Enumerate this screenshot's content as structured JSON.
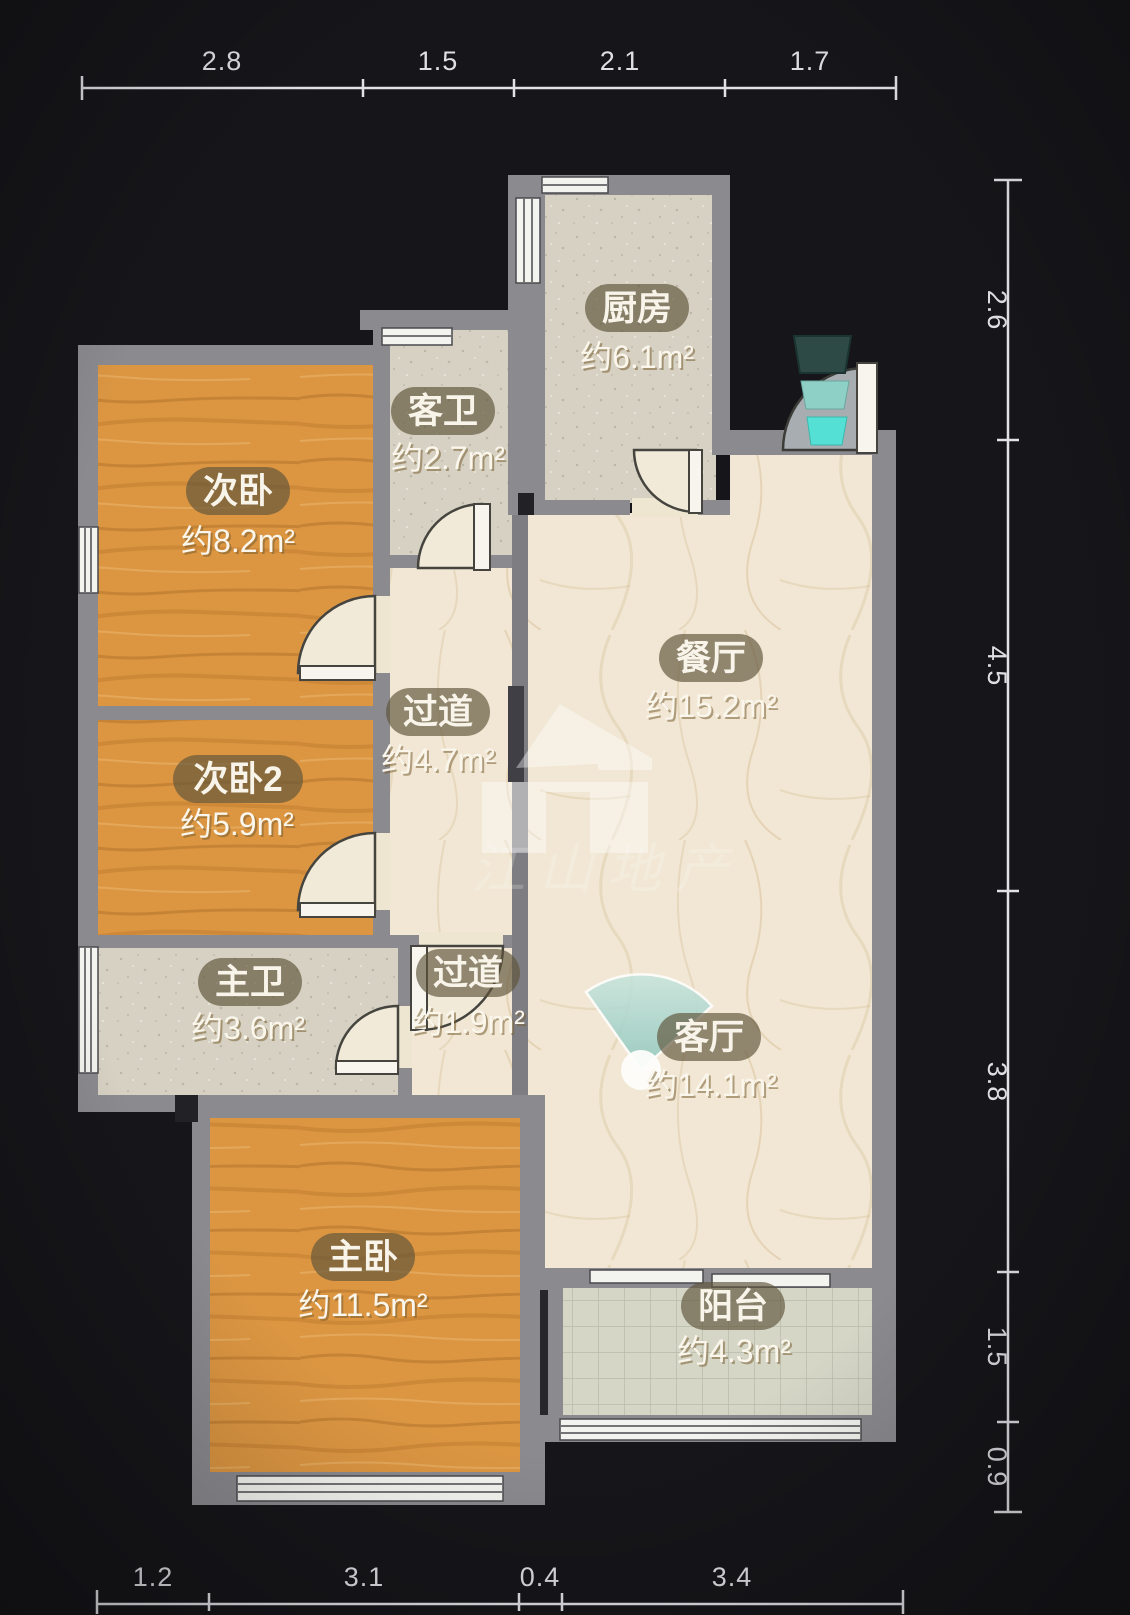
{
  "plan": {
    "type": "floorplan",
    "watermark": {
      "text": "江山地产"
    },
    "dimensions_m": {
      "top": [
        "2.8",
        "1.5",
        "2.1",
        "1.7"
      ],
      "right": [
        "2.6",
        "4.5",
        "3.8",
        "1.5",
        "0.9"
      ],
      "bottom": [
        "1.2",
        "3.1",
        "0.4",
        "3.4"
      ]
    },
    "rooms": {
      "ciwo": {
        "name": "次卧",
        "area": "约8.2m²"
      },
      "kewei": {
        "name": "客卫",
        "area": "约2.7m²"
      },
      "chufang": {
        "name": "厨房",
        "area": "约6.1m²"
      },
      "canting": {
        "name": "餐厅",
        "area": "约15.2m²"
      },
      "guodao1": {
        "name": "过道",
        "area": "约4.7m²"
      },
      "ciwo2": {
        "name": "次卧2",
        "area": "约5.9m²"
      },
      "zhuwei": {
        "name": "主卫",
        "area": "约3.6m²"
      },
      "guodao2": {
        "name": "过道",
        "area": "约1.9m²"
      },
      "keting": {
        "name": "客厅",
        "area": "约14.1m²"
      },
      "zhuwo": {
        "name": "主卧",
        "area": "约11.5m²"
      },
      "yangtai": {
        "name": "阳台",
        "area": "约4.3m²"
      }
    },
    "colors": {
      "background": "#16161a",
      "wall": "#8b8b8f",
      "wood_floor": "#dc9642",
      "marble_floor": "#f1e7d4",
      "tile_floor": "#d6d1c2",
      "balcony_floor": "#d5d6c6",
      "accent_teal": "#54e0d4",
      "dimension_text": "#dfdfe3",
      "label_text": "#f8f4ea"
    }
  }
}
